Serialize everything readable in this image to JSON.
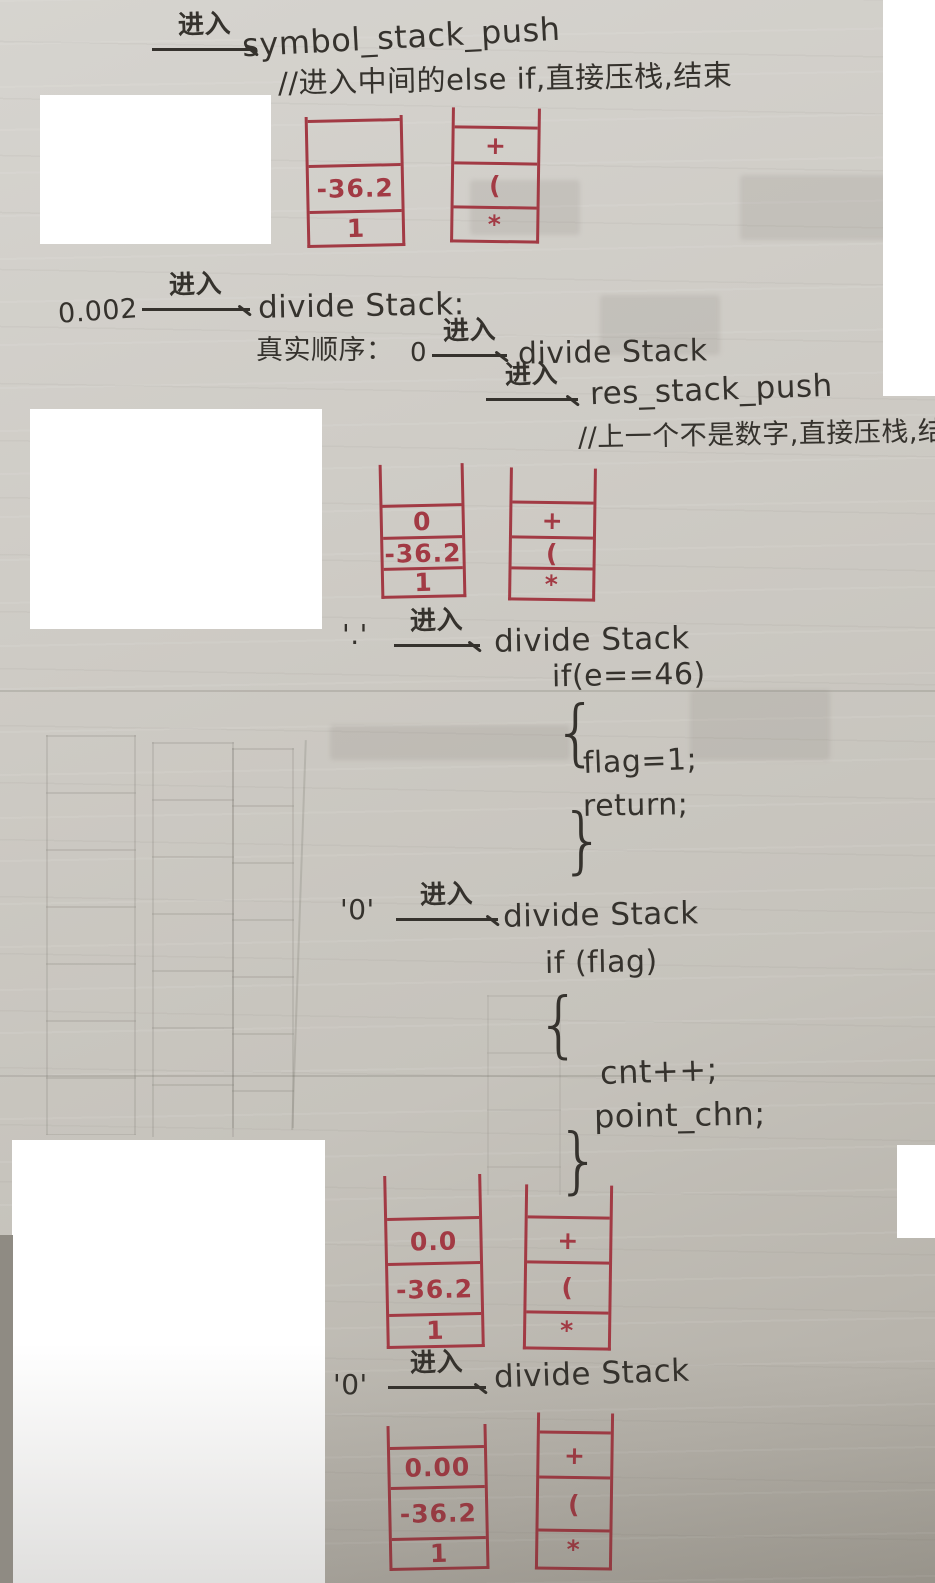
{
  "ink_colors": {
    "red": "#a23a44",
    "black": "#35322d"
  },
  "annotations": {
    "line1": {
      "arrow_label": "进入",
      "target": "symbol_stack_push"
    },
    "comment1": "//进入中间的else if,直接压栈,结束",
    "step2": {
      "input": "0.002",
      "arrow_label": "进入",
      "target": "divide Stack:"
    },
    "step3": {
      "prefix": "真实顺序：",
      "input": "0",
      "arrow_label": "进入",
      "target": "divide Stack"
    },
    "step4": {
      "arrow_label": "进入",
      "target": "res_stack_push"
    },
    "comment2": "//上一个不是数字,直接压栈,结束",
    "step5": {
      "input": "'.'",
      "arrow_label": "进入",
      "target": "divide Stack"
    },
    "code1": {
      "cond": "if(e==46)",
      "open": "{",
      "lines": [
        "flag=1;",
        "return;"
      ],
      "close": "}"
    },
    "step6": {
      "input": "'0'",
      "arrow_label": "进入",
      "target": "divide Stack"
    },
    "code2": {
      "cond": "if (flag)",
      "open": "{",
      "lines": [
        "cnt++;",
        "point_chn;"
      ],
      "close": "}"
    },
    "step7": {
      "input": "'0'",
      "arrow_label": "进入",
      "target": "divide Stack"
    }
  },
  "stacks": {
    "pair1": {
      "left": {
        "cells": [
          "",
          "-36.2",
          "1"
        ]
      },
      "right": {
        "cells": [
          "+",
          "(",
          "*"
        ]
      }
    },
    "pair2": {
      "left": {
        "cells": [
          "0",
          "-36.2",
          "1"
        ]
      },
      "right": {
        "cells": [
          "+",
          "(",
          "*"
        ]
      }
    },
    "pair3": {
      "left": {
        "cells": [
          "0.0",
          "-36.2",
          "1"
        ]
      },
      "right": {
        "cells": [
          "+",
          "(",
          "*"
        ]
      }
    },
    "pair4": {
      "left": {
        "cells": [
          "0.00",
          "-36.2",
          "1"
        ]
      },
      "right": {
        "cells": [
          "+",
          "(",
          "*"
        ]
      }
    }
  }
}
